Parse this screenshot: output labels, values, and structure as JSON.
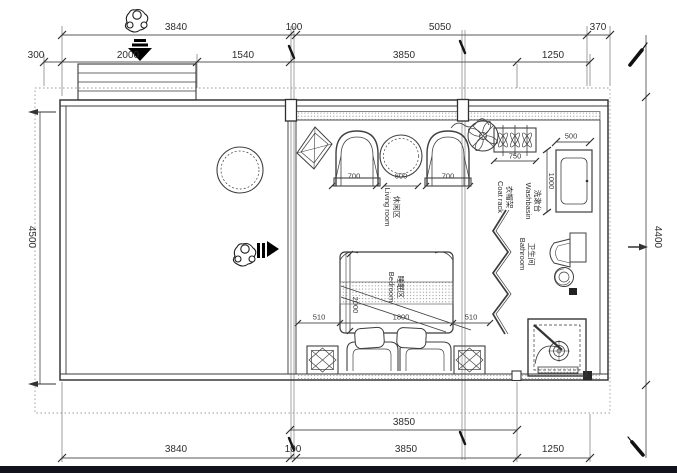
{
  "colors": {
    "ink": "#3d3d3d",
    "ink_light": "#8a8a8a",
    "black": "#000000",
    "paper": "#ffffff"
  },
  "dims": {
    "top_outer": [
      "3840",
      "100",
      "5050",
      "370"
    ],
    "top_inner": [
      "300",
      "2000",
      "1540",
      "3850",
      "1250"
    ],
    "left_height": "4500",
    "right_height": "4400",
    "bottom_inner": [
      "3850"
    ],
    "bottom_outer": [
      "3840",
      "100",
      "3850",
      "1250"
    ]
  },
  "furniture_dims": {
    "armchair_left": "700",
    "tea_table": "600",
    "armchair_right": "700",
    "coat_rack": "750",
    "washbasin_w": "500",
    "washbasin_d": "1000",
    "bed_gap_left": "510",
    "bed_width": "1800",
    "bed_gap_right": "510",
    "bed_length": "2000"
  },
  "rooms": {
    "living": {
      "zh": "休闲区",
      "en": "Living room"
    },
    "bedroom": {
      "zh": "睡眠区",
      "en": "Bedroom"
    },
    "bathroom": {
      "zh": "卫生间",
      "en": "Bathroom"
    },
    "washbasin": {
      "zh": "洗漱台",
      "en": "Washbasin"
    },
    "coat_rack": {
      "zh": "衣帽架",
      "en": "Coat rack"
    }
  }
}
